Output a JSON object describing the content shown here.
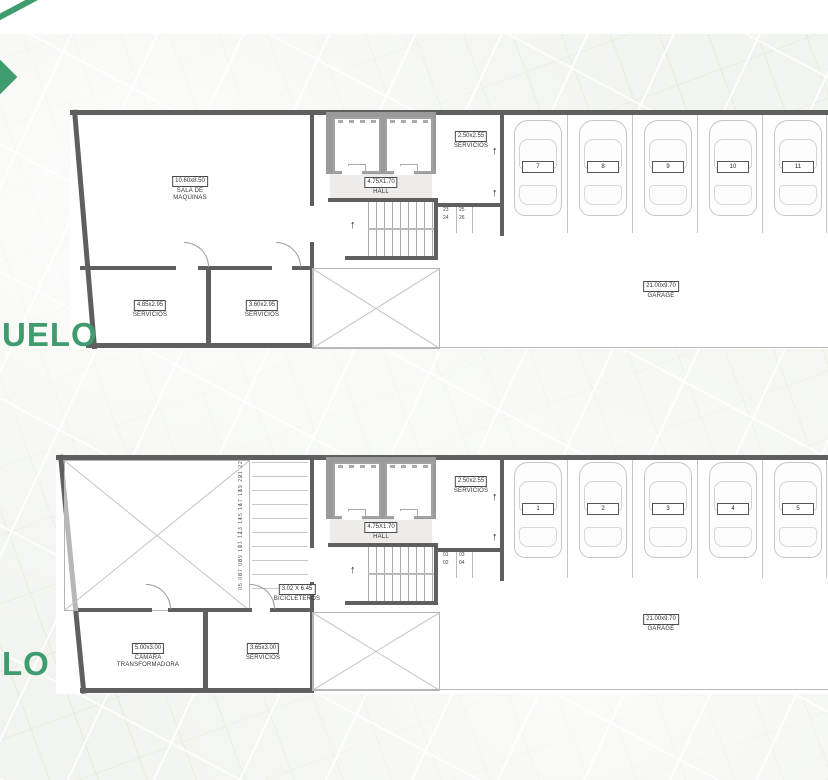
{
  "colors": {
    "accent_green": "#3E9C6E",
    "wall_gray": "#5f5f5f"
  },
  "levels": {
    "upper_label": "UELO",
    "lower_label": "LO"
  },
  "icons": {
    "up_arrow": "↑"
  },
  "upper": {
    "machine_room": {
      "dims": "10.60x8.50",
      "name": "SALA DE\nMAQUINAS"
    },
    "servicios_a": {
      "dims": "4.85x2.95",
      "name": "SERVICIOS"
    },
    "servicios_b": {
      "dims": "3.60x2.95",
      "name": "SERVICIOS"
    },
    "hall": {
      "dims": "4.75X1.70",
      "name": "HALL"
    },
    "servicios_c": {
      "dims": "2.50x2.55",
      "name": "SERVICIOS"
    },
    "garage": {
      "dims": "21.00x9.70",
      "name": "GARAGE"
    },
    "stair_slots": [
      "23",
      "24",
      "25",
      "26"
    ],
    "parking": [
      "7",
      "8",
      "9",
      "10",
      "11"
    ]
  },
  "lower": {
    "bicicleteros": {
      "dims": "3.02 X 6.45",
      "name": "BICICLETEROS"
    },
    "camara": {
      "dims": "5.00x3.00",
      "name": "CAMARA\nTRANSFORMADORA"
    },
    "servicios_a": {
      "dims": "3.65x3.00",
      "name": "SERVICIOS"
    },
    "hall": {
      "dims": "4.75X1.70",
      "name": "HALL"
    },
    "servicios_c": {
      "dims": "2.50x2.55",
      "name": "SERVICIOS"
    },
    "garage": {
      "dims": "21.00x9.70",
      "name": "GARAGE"
    },
    "stair_slots": [
      "01",
      "02",
      "03",
      "04"
    ],
    "bike_slots": [
      "21 22",
      "19 20",
      "17 18",
      "15 16",
      "13 14",
      "11 12",
      "09 10",
      "07 08",
      "05 06"
    ],
    "parking": [
      "1",
      "2",
      "3",
      "4",
      "5"
    ]
  }
}
